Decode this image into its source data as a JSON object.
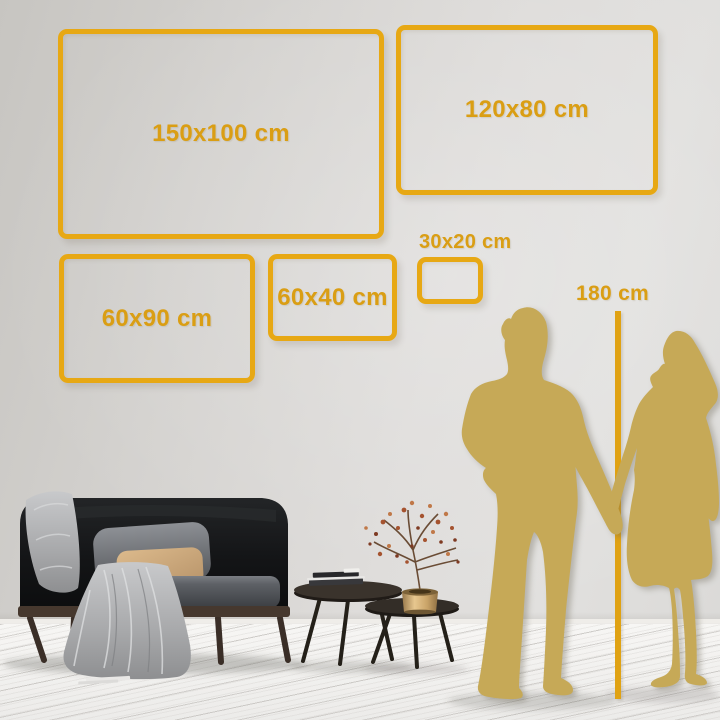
{
  "page": {
    "type": "wall-art-size-guide"
  },
  "size_chart": {
    "unit": "cm",
    "frames": [
      {
        "id": "150x100",
        "label": "150x100 cm",
        "x": 58,
        "y": 29,
        "w": 326,
        "h": 210,
        "label_inside": true
      },
      {
        "id": "120x80",
        "label": "120x80 cm",
        "x": 396,
        "y": 25,
        "w": 262,
        "h": 170,
        "label_inside": true
      },
      {
        "id": "60x90",
        "label": "60x90 cm",
        "x": 59,
        "y": 254,
        "w": 196,
        "h": 129,
        "label_inside": true
      },
      {
        "id": "60x40",
        "label": "60x40 cm",
        "x": 268,
        "y": 254,
        "w": 129,
        "h": 87,
        "label_inside": true
      },
      {
        "id": "30x20",
        "label": "30x20 cm",
        "x": 417,
        "y": 257,
        "w": 66,
        "h": 47,
        "label_inside": false
      }
    ],
    "height_reference": {
      "label": "180 cm"
    }
  },
  "colors": {
    "frame_gold": "#E7A814",
    "label_gold": "#DA9E14",
    "silhouette_gold": "#C6A957",
    "line_gold": "#E0A213",
    "wall": "#D8D6D3",
    "floor": "#F1F0EE"
  },
  "scene": {
    "objects": [
      "sofa",
      "throw-blanket",
      "gray-pillow",
      "tan-pillow",
      "nesting-coffee-tables",
      "books",
      "brass-vase",
      "dried-plant",
      "man-silhouette",
      "woman-silhouette"
    ]
  }
}
